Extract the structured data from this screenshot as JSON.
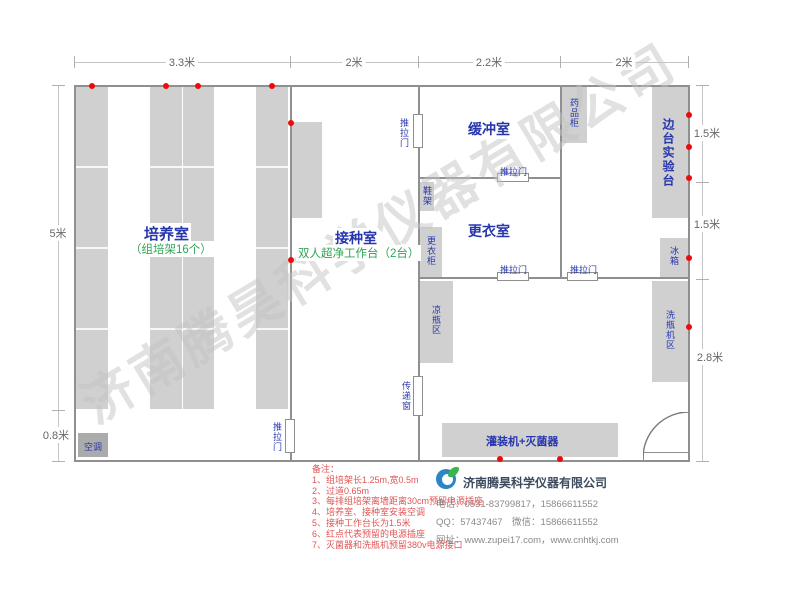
{
  "watermark": "济南腾昊科学仪器有限公司",
  "dimensions": {
    "top": [
      "3.3米",
      "2米",
      "2.2米",
      "2米"
    ],
    "left": [
      "5米",
      "0.8米"
    ],
    "right": [
      "1.5米",
      "1.5米",
      "2.8米"
    ]
  },
  "rooms": {
    "cultivation": {
      "name": "培养室",
      "sub": "（组培架16个）"
    },
    "inoculation": {
      "name": "接种室",
      "sub": "双人超净工作台（2台）"
    },
    "buffer": {
      "name": "缓冲室"
    },
    "changing": {
      "name": "更衣室"
    },
    "side_bench": {
      "name": "边台实验台"
    }
  },
  "fixtures": {
    "medicine_cabinet": "药品柜",
    "shoe_rack": "鞋架",
    "wardrobe": "更衣柜",
    "cooling_area": "凉瓶区",
    "pass_window": "传递窗",
    "filling_machine": "灌装机+灭菌器",
    "fridge": "冰箱",
    "washer_area": "洗瓶机区",
    "air_conditioner": "空调",
    "sliding_door": "推拉门"
  },
  "notes": {
    "title": "备注：",
    "items": [
      "1、组培架长1.25m,宽0.5m",
      "2、过道0.65m",
      "3、每排组培架离墙距离30cm预留电源插座",
      "4、培养室、接种室安装空调",
      "5、接种工作台长为1.5米",
      "6、红点代表预留的电源插座",
      "7、灭菌器和洗瓶机预留380v电源接口"
    ]
  },
  "company": {
    "name": "济南腾昊科学仪器有限公司",
    "phone_line": "电话：0531-83799817，15866611552",
    "qq_line": "QQ：57437467　微信：15866611552",
    "web_line": "网址：www.zupei17.com，www.cnhtkj.com"
  },
  "colors": {
    "wall": "#8f8f8f",
    "furniture": "#d0d0d0",
    "room_label_blue": "#2736ad",
    "sub_label_green": "#2fa455",
    "note_red": "#e05555",
    "outlet_dot_red": "#ee0a0a"
  }
}
